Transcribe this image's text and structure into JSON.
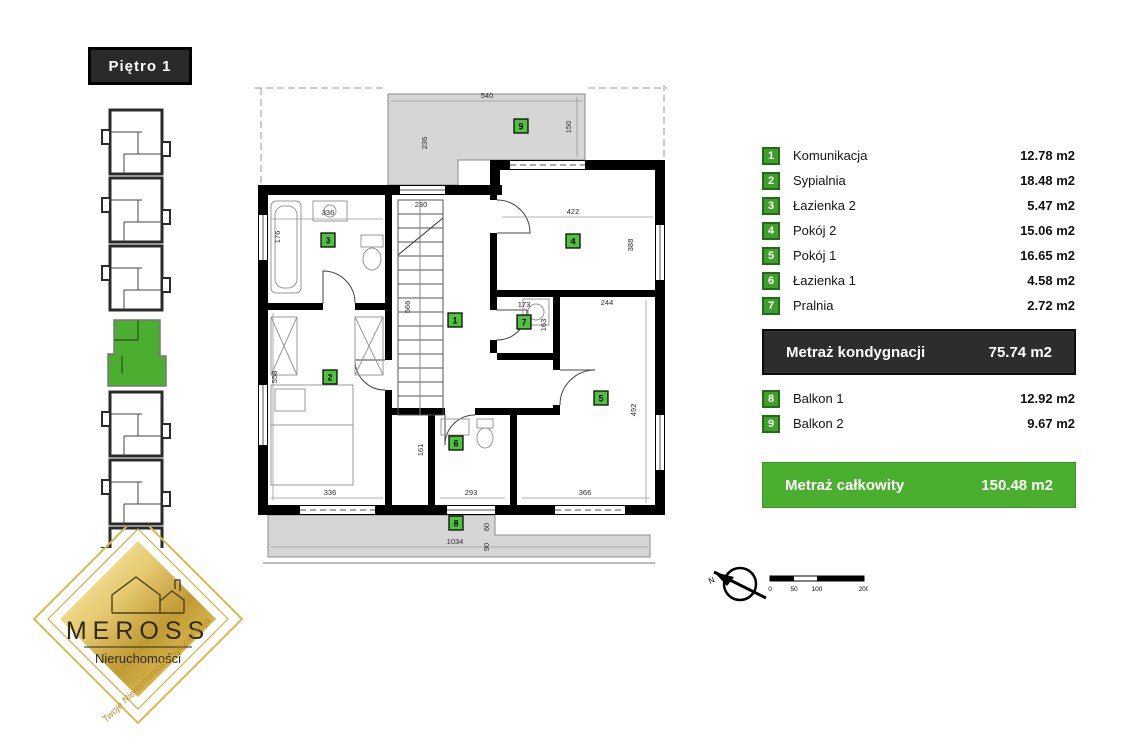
{
  "floor_label": "Piętro 1",
  "legend": {
    "rooms": [
      {
        "num": "1",
        "label": "Komunikacja",
        "area": "12.78 m2"
      },
      {
        "num": "2",
        "label": "Sypialnia",
        "area": "18.48 m2"
      },
      {
        "num": "3",
        "label": "Łazienka 2",
        "area": "5.47 m2"
      },
      {
        "num": "4",
        "label": "Pokój 2",
        "area": "15.06 m2"
      },
      {
        "num": "5",
        "label": "Pokój 1",
        "area": "16.65 m2"
      },
      {
        "num": "6",
        "label": "Łazienka 1",
        "area": "4.58 m2"
      },
      {
        "num": "7",
        "label": "Pralnia",
        "area": "2.72 m2"
      }
    ],
    "floor_total": {
      "label": "Metraż kondygnacji",
      "area": "75.74 m2"
    },
    "balconies": [
      {
        "num": "8",
        "label": "Balkon 1",
        "area": "12.92 m2"
      },
      {
        "num": "9",
        "label": "Balkon 2",
        "area": "9.67 m2"
      }
    ],
    "grand_total": {
      "label": "Metraż całkowity",
      "area": "150.48 m2"
    }
  },
  "plan": {
    "badges": [
      "1",
      "2",
      "3",
      "4",
      "5",
      "6",
      "7",
      "8",
      "9"
    ],
    "dims": {
      "top": "540",
      "right_top": "150",
      "col": "236",
      "r3w": "336",
      "r3h": "176",
      "stairs": "230",
      "stairh": "566",
      "r4w": "422",
      "r4h": "388",
      "r7w": "173",
      "r7h": "163",
      "r5top": "244",
      "r2h": "558",
      "r2w": "336",
      "r6h": "161",
      "r6w": "293",
      "r5w": "366",
      "r5h": "492",
      "balk8": "1034",
      "b8a": "60",
      "b8b": "90"
    }
  },
  "compass": {
    "north_label": "N"
  },
  "scalebar": {
    "ticks": [
      "0",
      "50",
      "100",
      "200"
    ]
  },
  "logo": {
    "brand": "MEROSS",
    "subtitle": "Nieruchomości",
    "tagline": "Twoje Nieruchomości Nasza Pasja"
  },
  "colors": {
    "accent_green": "#4aae2e",
    "dark_bar": "#2d2d2d",
    "badge_green": "#4ec43d",
    "balcony_gray": "#d6d6d6"
  }
}
